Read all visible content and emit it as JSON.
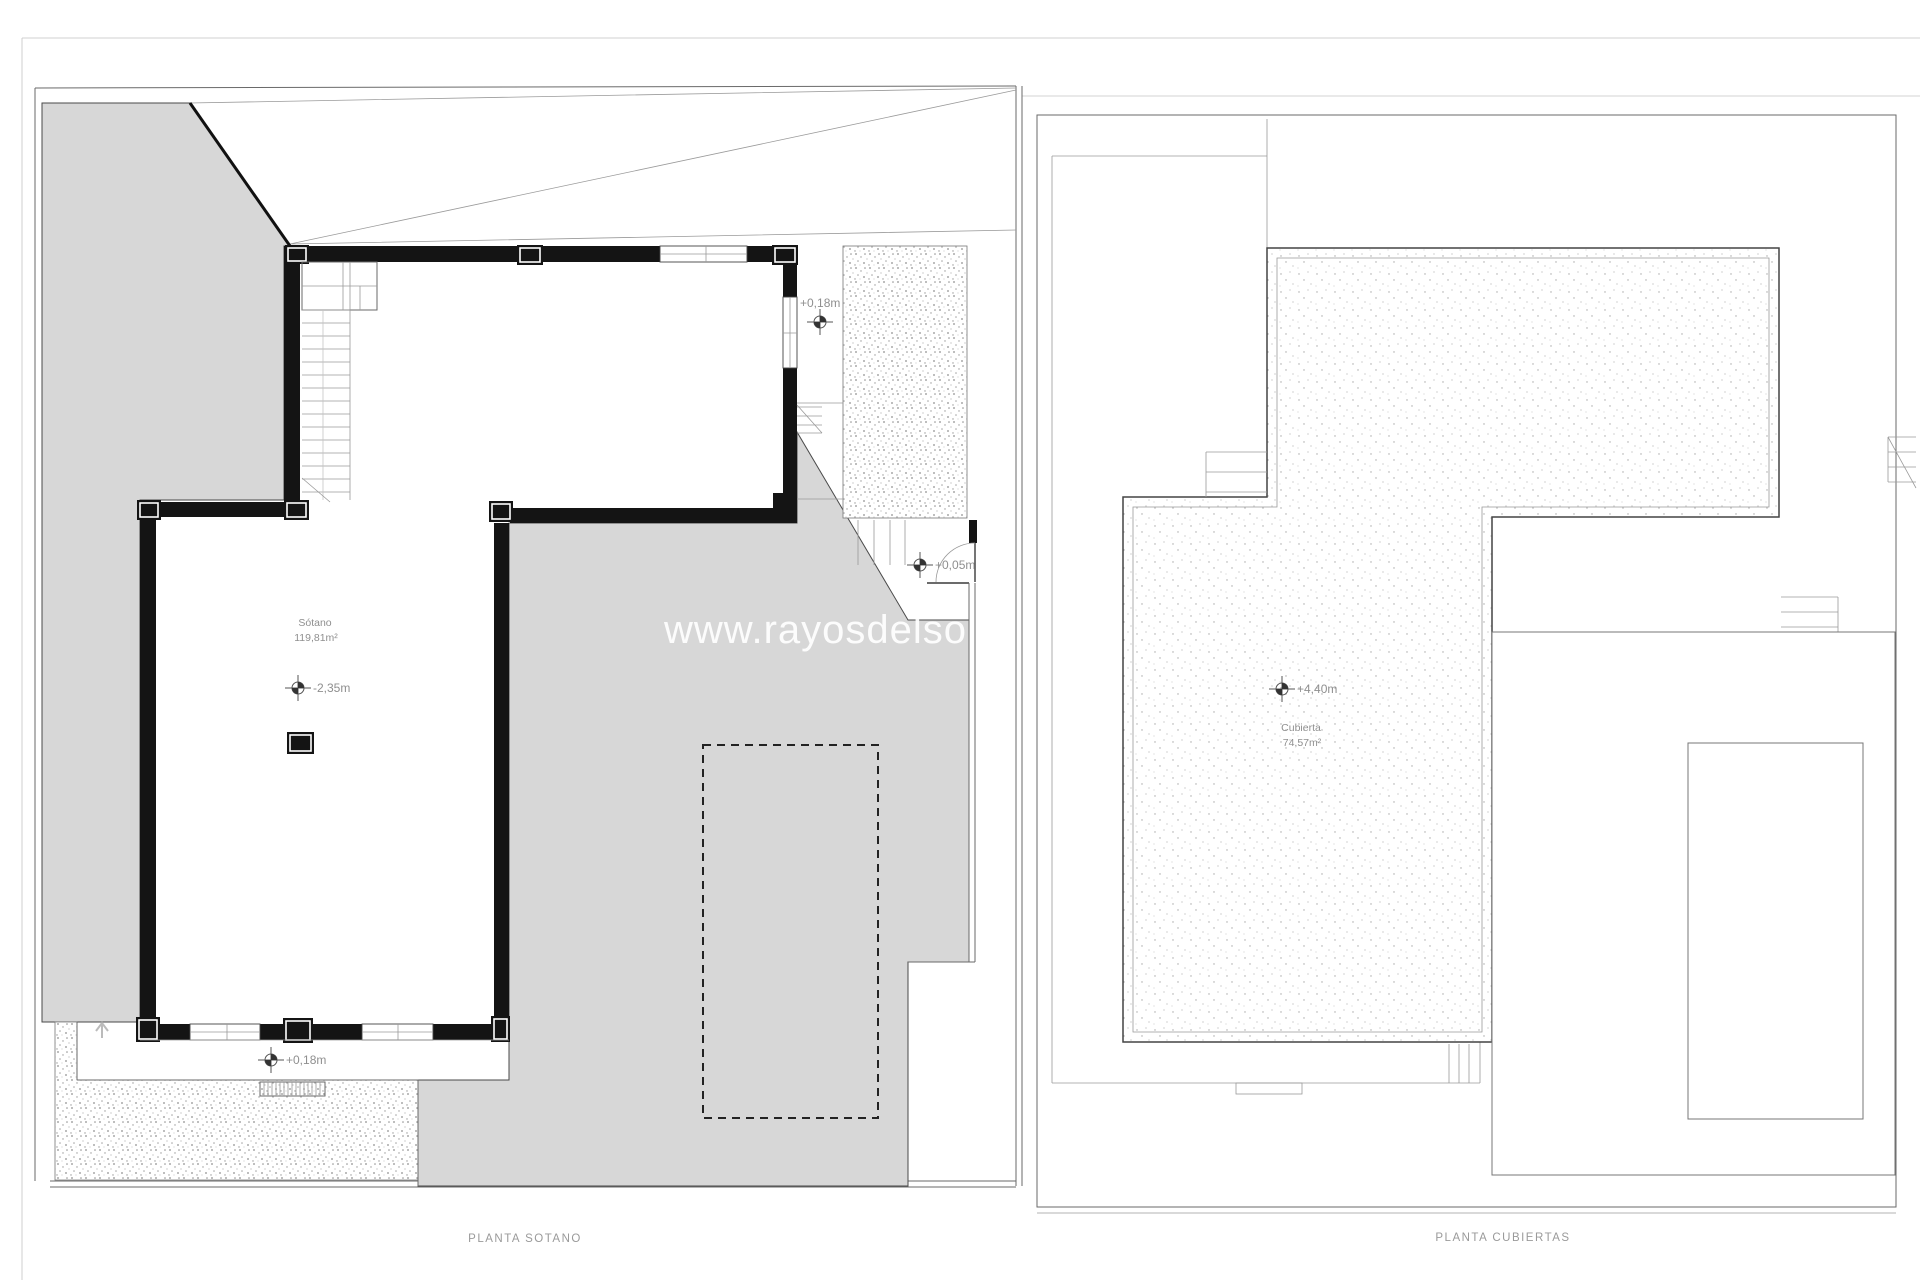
{
  "watermark": {
    "text": "www.rayosdelsol"
  },
  "basement": {
    "caption": "PLANTA SOTANO",
    "room": "Sótano",
    "room_area": "119,81m²",
    "level_center": "-2,35m",
    "level_top_right": "+0,18m",
    "level_entry": "+0,05m",
    "level_porch": "+0,18m"
  },
  "roof": {
    "caption": "PLANTA CUBIERTAS",
    "room": "Cubierta",
    "room_area": "74,57m²",
    "level_roof": "+4,40m"
  },
  "colors": {
    "wall": "#141414",
    "terrace": "#d7d7d7",
    "line_dark": "#3a3a3a",
    "line_light": "#9a9a9a",
    "label": "#8f8f8f",
    "watermark_color": "#ffffff"
  }
}
